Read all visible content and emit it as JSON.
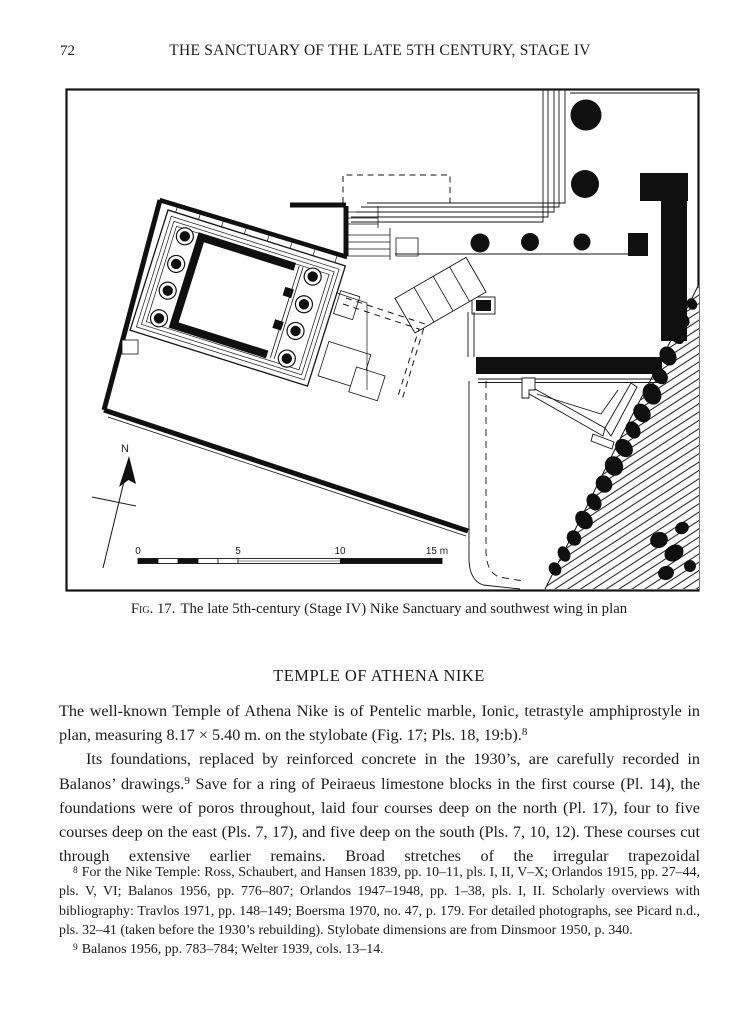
{
  "colors": {
    "ink": "#1b1b1b",
    "paper": "#fefefe"
  },
  "page": {
    "number": "72",
    "running_header": "THE SANCTUARY OF THE LATE 5TH CENTURY, STAGE IV"
  },
  "figure": {
    "caption_label": "Fig. 17.",
    "caption_text": "The late 5th-century (Stage IV) Nike Sanctuary and southwest wing in plan",
    "north_label": "N",
    "scale": {
      "ticks": [
        "0",
        "5",
        "10",
        "15 m"
      ]
    }
  },
  "section": {
    "heading": "TEMPLE OF ATHENA NIKE"
  },
  "paragraphs": {
    "p1": {
      "before": "The well-known Temple of Athena Nike is of Pentelic marble, Ionic, tetrastyle amphiprostyle in plan, measuring 8.17 × 5.40 m. on the stylobate (Fig. 17; Pls. 18, 19:b).",
      "fnref": "8"
    },
    "p2": {
      "before": "Its foundations, replaced by reinforced concrete in the 1930’s, are carefully recorded in Balanos’ drawings.",
      "fnref": "9",
      "after": " Save for a ring of Peiraeus limestone blocks in the first course (Pl. 14), the foundations were of poros throughout, laid four courses deep on the north (Pl. 17), four to five courses deep on the east (Pls. 7, 17), and five deep on the south (Pls. 7, 10, 12). These courses cut through extensive earlier remains. Broad stretches of the irregular trapezoidal"
    }
  },
  "footnotes": {
    "fn8": {
      "marker": "8",
      "text": "For the Nike Temple:  Ross, Schaubert, and Hansen 1839, pp. 10–11, pls. I, II, V–X; Orlandos 1915, pp. 27–44, pls. V, VI; Balanos 1956, pp. 776–807; Orlandos 1947–1948, pp. 1–38, pls. I, II. Scholarly overviews with bibliography:  Travlos 1971, pp. 148–149; Boersma 1970, no. 47, p. 179. For detailed photographs, see Picard n.d., pls. 32–41 (taken before the 1930’s rebuilding). Stylobate dimensions are from Dinsmoor 1950, p. 340."
    },
    "fn9": {
      "marker": "9",
      "text": "Balanos 1956, pp. 783–784; Welter 1939, cols. 13–14."
    }
  }
}
